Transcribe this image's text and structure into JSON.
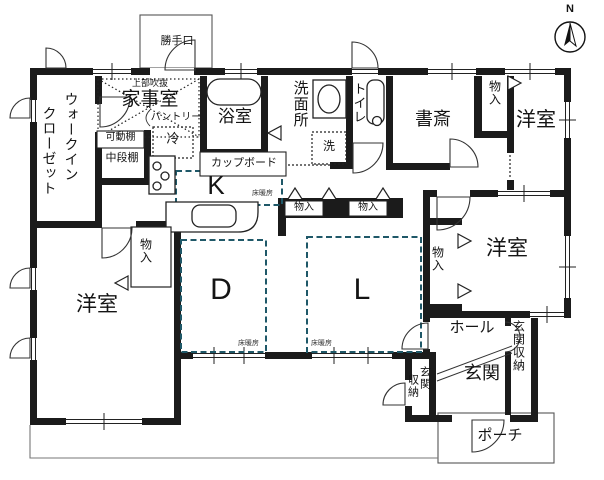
{
  "compass": {
    "label": "N"
  },
  "colors": {
    "wall": "#1b1b1b",
    "line": "#2b2b2b",
    "floor_heating_dash": "#1f5868",
    "background": "#ffffff",
    "eave_line": "#777777"
  },
  "labels": {
    "katteguchi": "勝手口",
    "jobu_fukinuke": "上部吹抜",
    "kajishitsu": "家事室",
    "wic_line1": "ウォークイン",
    "wic_line2": "クローゼット",
    "kadodana": "可動棚",
    "pantry": "パントリー",
    "reizoko": "冷",
    "chudandana": "中段棚",
    "yokushitsu": "浴室",
    "cupboard": "カップボード",
    "senmenjo": "洗面所",
    "sentakuki": "洗",
    "toire": "トイレ",
    "shosai": "書斎",
    "monoiri": "物入",
    "yoshitsu": "洋室",
    "kitchen": "K",
    "dining": "D",
    "living": "L",
    "yukadanbo": "床暖房",
    "hall": "ホール",
    "genkan": "玄関",
    "genkan_shuno": "玄関収納",
    "genkan_shuno_line1": "玄関",
    "genkan_shuno_line2": "収納",
    "porch": "ポーチ"
  },
  "floor_heating_rooms": [
    "K",
    "D",
    "L"
  ]
}
